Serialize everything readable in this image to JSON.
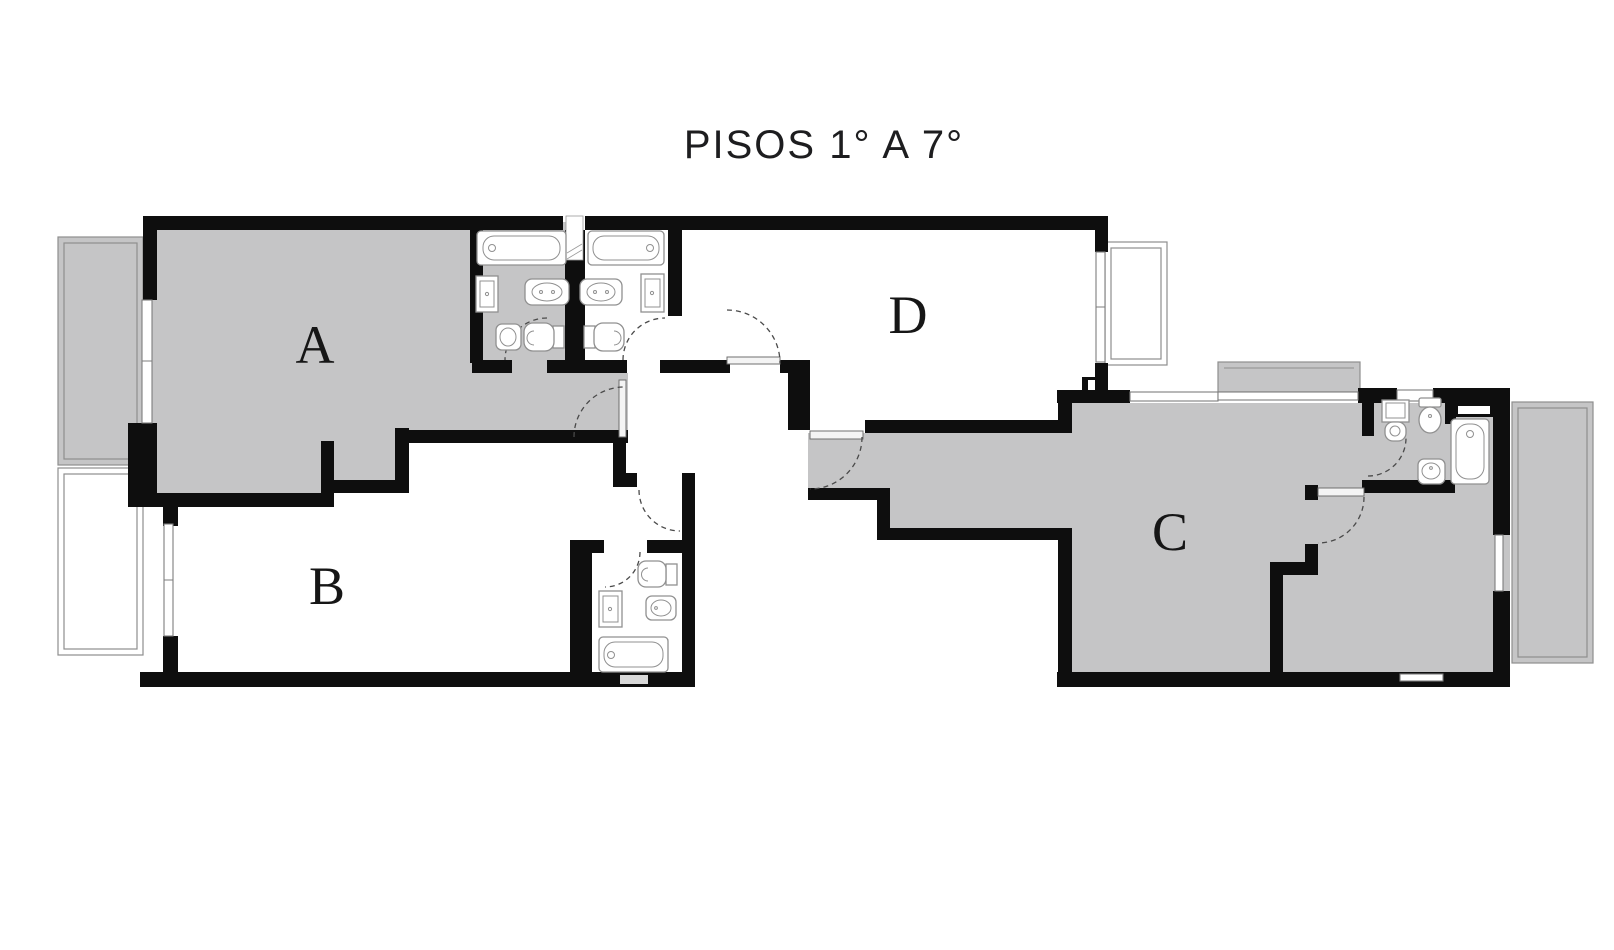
{
  "title": {
    "text": "PISOS 1° A 7°"
  },
  "units": {
    "a": {
      "label": "A"
    },
    "b": {
      "label": "B"
    },
    "c": {
      "label": "C"
    },
    "d": {
      "label": "D"
    }
  },
  "colors": {
    "wall": "#0e0e0e",
    "room_fill": "#c5c5c6",
    "balcony_line": "#8e8e8e",
    "fixture_line": "#909090",
    "door_arc": "#4a4a4a",
    "window_line": "#7d7d7d",
    "label_text": "#161616",
    "title_text": "#1d1d1f",
    "background": "#ffffff"
  }
}
